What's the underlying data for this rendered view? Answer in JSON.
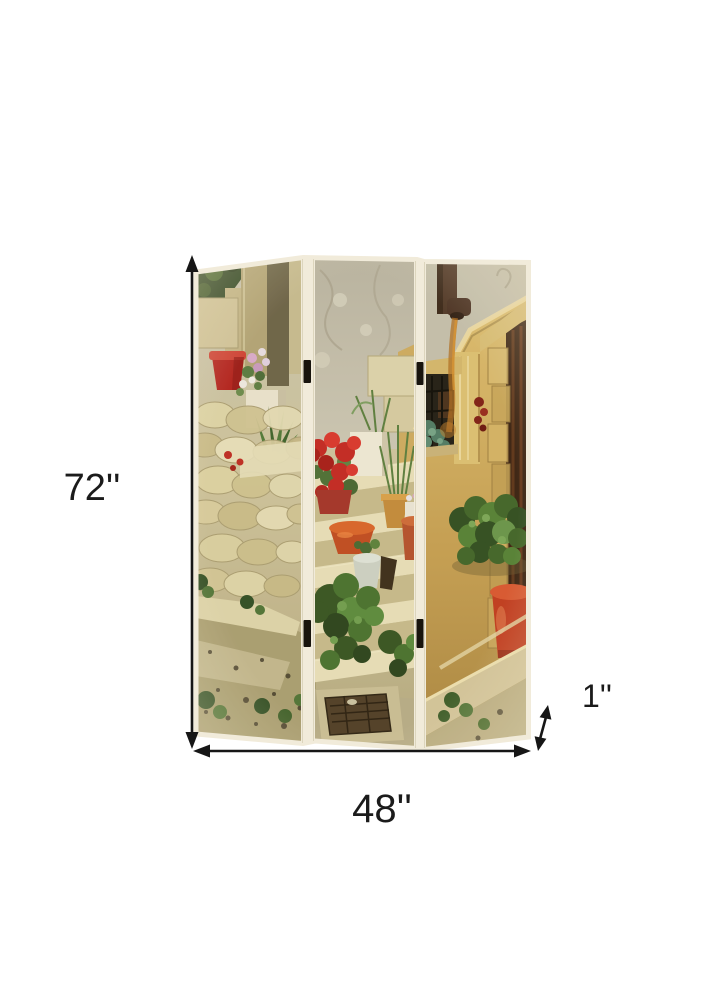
{
  "product_image": {
    "type": "three-panel folding room divider screen",
    "panel_count": 3,
    "artwork": "vintage mediterranean stone street with steps, potted flowers, golden wall, window and rustic door"
  },
  "dimensions": {
    "height": "72''",
    "width": "48''",
    "depth": "1''"
  },
  "colors": {
    "background": "#ffffff",
    "dimension_lines": "#161616",
    "label_text": "#1b1b1b",
    "panel_edge": "#f1ebda",
    "hinge": "#18140d",
    "stone_wall": "#d8cda1",
    "golden_wall": "#cfa958",
    "terracotta": "#c06a2c",
    "geranium_red": "#c22620",
    "foliage_green": "#47702c"
  }
}
